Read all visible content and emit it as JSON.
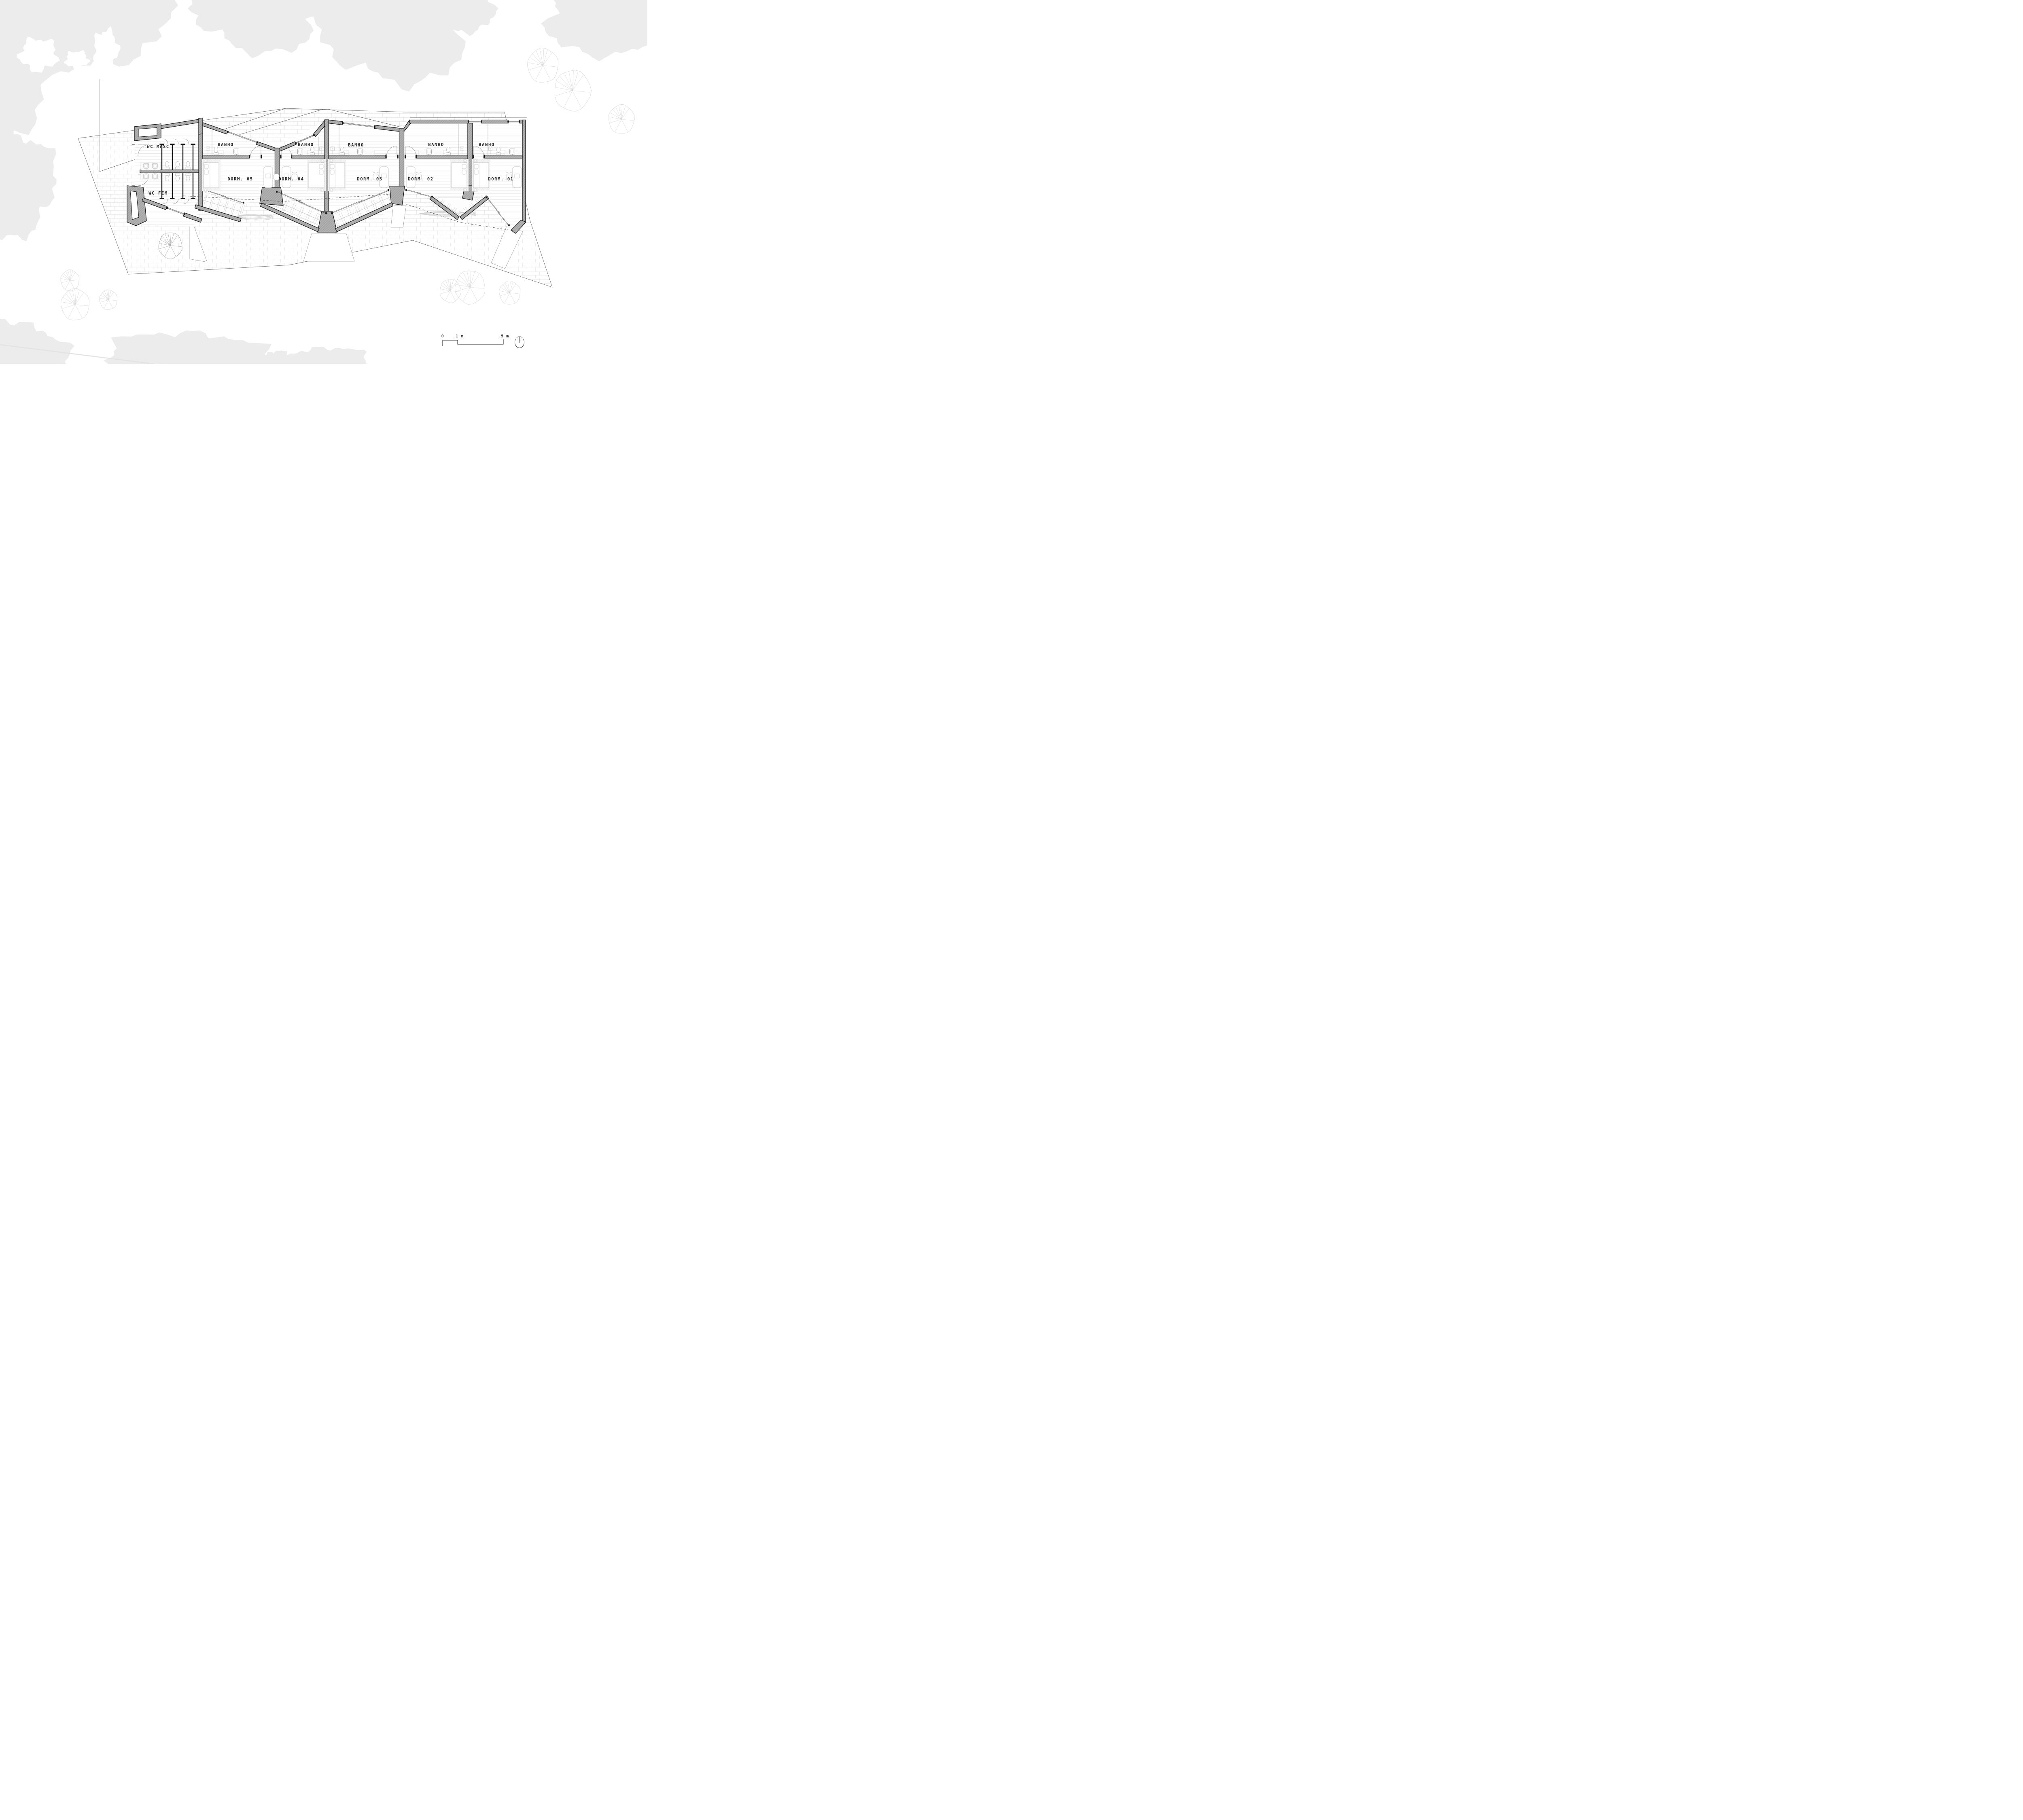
{
  "drawing": {
    "type": "architectural-floor-plan",
    "rooms": {
      "wc_masc_label": "WC MASC",
      "wc_fem_label": "WC FEM",
      "units": [
        {
          "bath": "BANHO",
          "dorm": "DORM. 05"
        },
        {
          "bath": "BANHO",
          "dorm": "DORM. 04"
        },
        {
          "bath": "BANHO",
          "dorm": "DORM. 03"
        },
        {
          "bath": "BANHO",
          "dorm": "DORM. 02"
        },
        {
          "bath": "BANHO",
          "dorm": "DORM. 01"
        }
      ]
    },
    "scale_bar": {
      "zero_label": "0",
      "one_label": "1 m",
      "five_label": "5 m"
    },
    "icons": {
      "north_indicator": "compass-circle-with-needle"
    },
    "colors": {
      "background": "#ffffff",
      "wall_fill": "#b0b0b0",
      "wall_hatch": "#8a8a8a",
      "wall_edge": "#161616",
      "floor_plank_line": "#e2e2e2",
      "brick_joint_line": "#e7e7e7",
      "canopy_fill": "#ececec",
      "tree_outline_faint": "#d4d4d4",
      "tree_outline_dark": "#9b9b9b",
      "furniture_outline": "#c2c2c2",
      "text": "#232323"
    }
  }
}
